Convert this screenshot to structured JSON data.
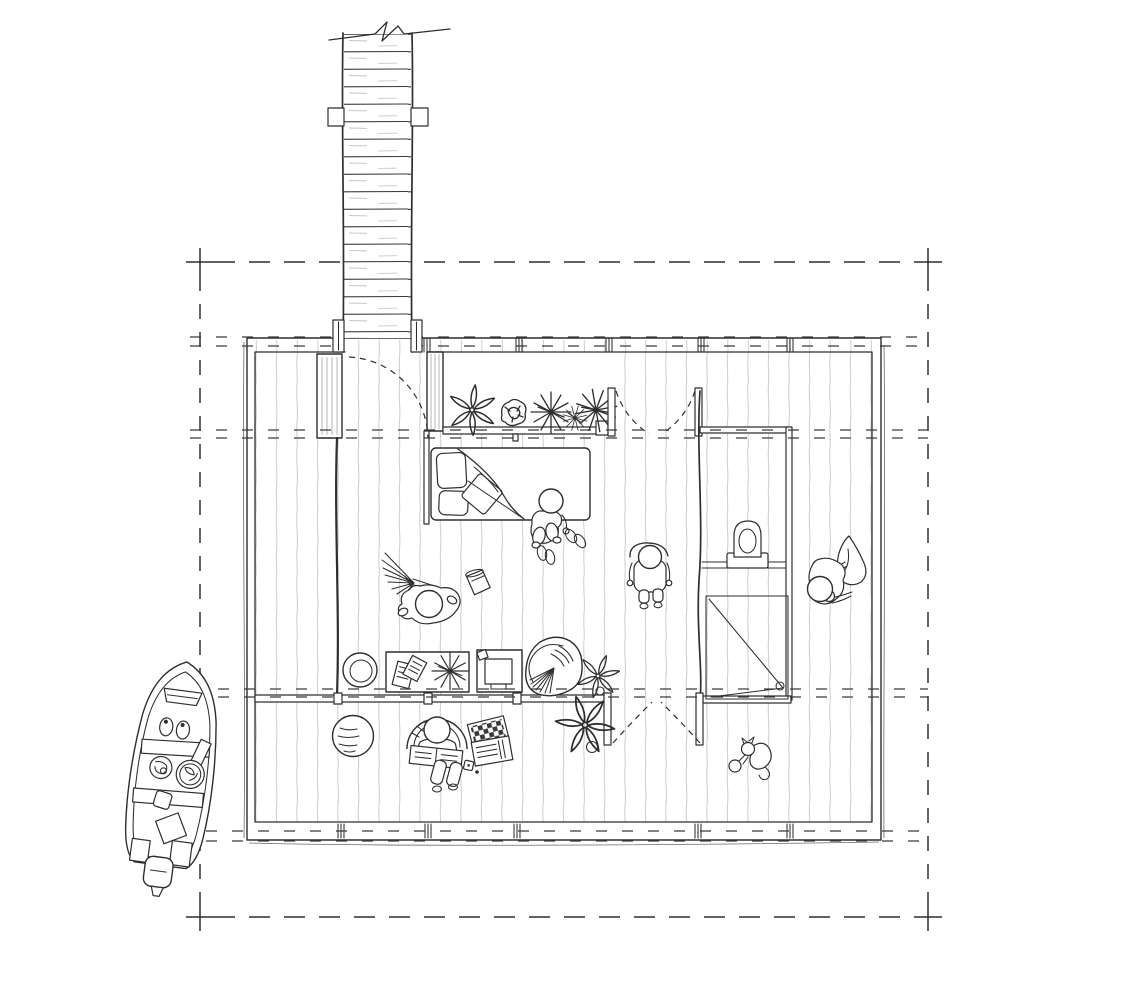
{
  "title": "Hand-drawn cabin floor plan with dock and boat",
  "colors": {
    "background": "#ffffff",
    "ink": "#2e2e2e",
    "plank": "#cdcdcd",
    "hatch": "#b4b4b4"
  },
  "drawing": {
    "dock": "Timber dock with plank decking, break line and side cleats",
    "boundary": "Dashed setout boundary with corner crosses",
    "grid": "Dashed structural grid lines crossing the plan",
    "house": "Timber cabin with plank flooring throughout",
    "entry": {
      "closet": "Entry closet",
      "door": "Entry door swinging in from the dock"
    },
    "planter_bay": {
      "label": "Window bay shelf with potted plants",
      "plants": 5
    },
    "bedroom": {
      "bed": "Bed with pillows, cushion and folded blanket",
      "person": "Person sitting on the bed edge",
      "slippers": "Two pairs of slippers"
    },
    "hall": {
      "north_doors": "Double swing doors",
      "south_doors": "Double swing doors to the deck",
      "person": "Person standing in the hall"
    },
    "bathroom": {
      "toilet": "Toilet",
      "counter": "Vanity counter",
      "shower": "Shower with diagonal screen and drain"
    },
    "dressing_person": "Person pulling a sweater overhead",
    "living_room": {
      "basket": "Round basket",
      "desk": "Desk with papers and plant",
      "computer_desk": "Desk with computer monitor",
      "chair": "Swivel armchair",
      "plant": "Potted plant",
      "sweeper": "Person sweeping with a broom",
      "bucket": "Bucket"
    },
    "deck": {
      "rug": "Round rug",
      "reader": "Person reading in a curved chair",
      "games": "Game boxes, die and marble",
      "plant": "Potted plant",
      "cat": "Cat playing with a ball"
    },
    "boat": {
      "label": "Open motorboat moored beside the dock",
      "details": "Bow deck, two bench seats, rope coils, cargo box and outboard motor"
    },
    "people_count": 5,
    "animals_count": 1
  }
}
